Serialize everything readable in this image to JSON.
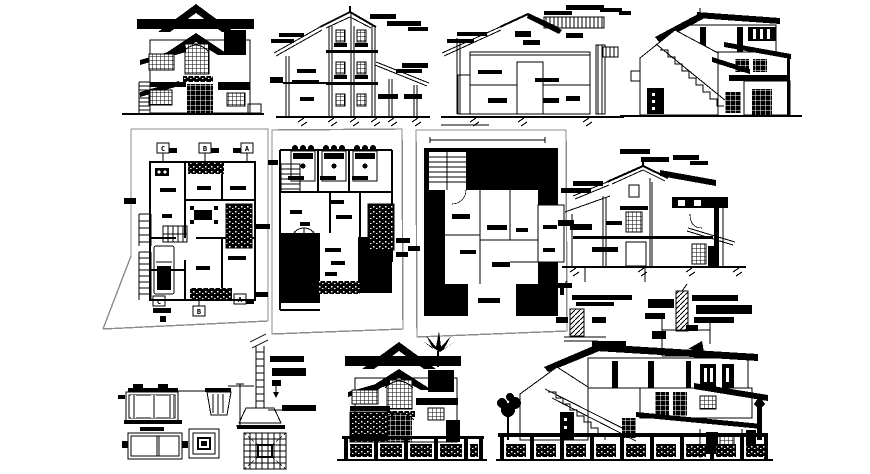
{
  "canvas": {
    "width": 870,
    "height": 474,
    "background": "#ffffff",
    "ink": "#000000",
    "sheet_edge": "#8c8c8c"
  },
  "drawings": [
    {
      "id": "front-elevation"
    },
    {
      "id": "section-bb"
    },
    {
      "id": "section-aa"
    },
    {
      "id": "side-elevation-with-stair"
    },
    {
      "id": "ground-floor-plan"
    },
    {
      "id": "first-floor-plan"
    },
    {
      "id": "terrace-floor-plan"
    },
    {
      "id": "cross-section"
    },
    {
      "id": "beam-detail"
    },
    {
      "id": "parapet-detail"
    },
    {
      "id": "septic-tank-detail"
    },
    {
      "id": "column-footing-detail"
    },
    {
      "id": "front-elevation-with-compound-wall"
    },
    {
      "id": "side-elevation-with-compound-wall"
    }
  ],
  "ground_floor_plan": {
    "section_markers_top": [
      "C",
      "B",
      "A"
    ],
    "section_markers_bottom": [
      "C",
      "B",
      "A"
    ]
  }
}
